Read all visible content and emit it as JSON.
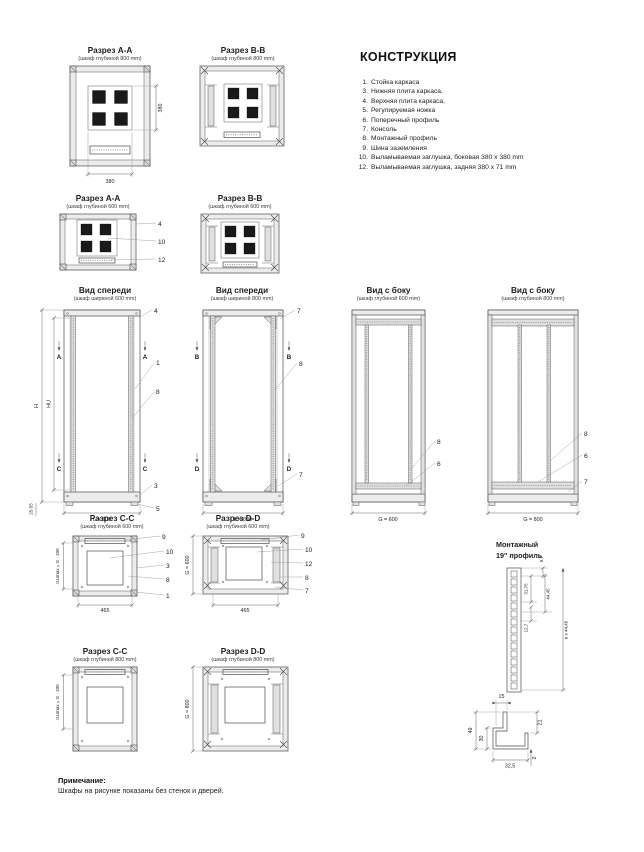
{
  "construction": {
    "title": "КОНСТРУКЦИЯ",
    "items": [
      {
        "n": "1.",
        "t": "Стойка каркаса"
      },
      {
        "n": "3.",
        "t": "Нижняя плита каркаса,"
      },
      {
        "n": "4.",
        "t": "Верхняя плита каркаса,"
      },
      {
        "n": "5.",
        "t": "Регулируемая ножка"
      },
      {
        "n": "6.",
        "t": "Поперечный профиль"
      },
      {
        "n": "7.",
        "t": "Консоль"
      },
      {
        "n": "8.",
        "t": "Монтажный профиль"
      },
      {
        "n": "9.",
        "t": "Шина заземления"
      },
      {
        "n": "10.",
        "t": "Выламываемая заглушка, боковая 380 x 380 mm"
      },
      {
        "n": "12.",
        "t": "Выламываемая заглушка, задняя 380 x 71 mm"
      }
    ]
  },
  "figures": {
    "aa800": {
      "title": "Разрез A-A",
      "subtitle": "(шкаф глубиной 800 mm)",
      "dim_side": "380",
      "dim_bottom": "380"
    },
    "bb800": {
      "title": "Разрез B-B",
      "subtitle": "(шкаф глубиной 800 mm)"
    },
    "aa600": {
      "title": "Разрез A-A",
      "subtitle": "(шкаф глубиной 600 mm)",
      "c1": "4",
      "c2": "10",
      "c3": "12"
    },
    "bb600": {
      "title": "Разрез B-B",
      "subtitle": "(шкаф глубиной 600 mm)"
    },
    "front600": {
      "title": "Вид спереди",
      "subtitle": "(шкаф шириной 600 mm)",
      "dim_h": "H",
      "dim_hu": "HU",
      "dim_l": "L = 600",
      "dim_foot": "25-55",
      "mk_top": "A",
      "mk_bot": "C",
      "c1": "4",
      "c2": "1",
      "c3": "8",
      "c4": "3",
      "c5": "5"
    },
    "front800": {
      "title": "Вид спереди",
      "subtitle": "(шкаф шириной 800 mm)",
      "dim_l": "L = 800",
      "mk_top": "B",
      "mk_bot": "D",
      "c1": "7",
      "c2": "8",
      "c3": "7"
    },
    "side600": {
      "title": "Вид с боку",
      "subtitle": "(шкаф глубиной 600 mm)",
      "dim_g": "G = 600",
      "c1": "8",
      "c2": "6"
    },
    "side800": {
      "title": "Вид с боку",
      "subtitle": "(шкаф глубиной 800 mm)",
      "dim_g": "G = 800",
      "c1": "8",
      "c2": "6",
      "c3": "7"
    },
    "cc600": {
      "title": "Разрез C-C",
      "subtitle": "(шкаф глубиной 600 mm)",
      "dim_gu": "GUmax = G - 100",
      "dim_b": "465",
      "c1": "9",
      "c2": "10",
      "c3": "3",
      "c4": "8",
      "c5": "1"
    },
    "dd600": {
      "title": "Разрез D-D",
      "subtitle": "(шкаф глубиной 600 mm)",
      "dim_g": "G = 600",
      "dim_b": "465",
      "c1": "9",
      "c2": "10",
      "c3": "12",
      "c4": "8",
      "c5": "7"
    },
    "cc800": {
      "title": "Разрез C-C",
      "subtitle": "(шкаф глубиной 800 mm)",
      "dim_gu": "GUmax = G - 100"
    },
    "dd800": {
      "title": "Разрез D-D",
      "subtitle": "(шкаф глубиной 800 mm)",
      "dim_g": "G = 800"
    },
    "rail19": {
      "title1": "Монтажный",
      "title2": "19\" профиль",
      "d1": "6,7",
      "d2": "31,75",
      "d3": "44,45",
      "d4": "12,7",
      "d5": "n x 44,45"
    },
    "profile": {
      "d_top": "15",
      "d_right": "21",
      "d_left": "49",
      "d_inner": "30",
      "d_bottom": "32,5",
      "d_thk": "2"
    }
  },
  "note": {
    "label": "Примечание:",
    "text": "Шкафы на рисунке показаны без стенок и дверей."
  }
}
